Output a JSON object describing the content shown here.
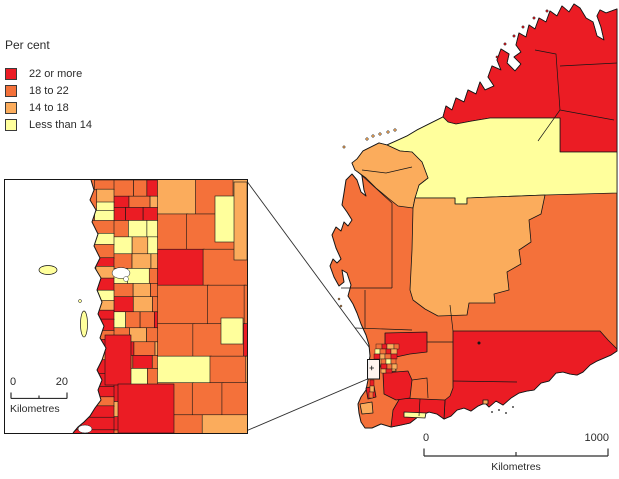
{
  "legend": {
    "title": "Per cent",
    "items": [
      {
        "label": "22 or more",
        "color": "#EB1C24"
      },
      {
        "label": "18 to 22",
        "color": "#F4713A"
      },
      {
        "label": "14 to 18",
        "color": "#FBAC5C"
      },
      {
        "label": "Less than 14",
        "color": "#FFFF9C"
      }
    ]
  },
  "inset_map": {
    "scale_bar": {
      "start": "0",
      "end": "20",
      "unit": "Kilometres"
    }
  },
  "main_map": {
    "scale_bar": {
      "start": "0",
      "end": "1000",
      "unit": "Kilometres"
    }
  },
  "style": {
    "outline_color": "#161616",
    "water_color": "#ffffff"
  }
}
